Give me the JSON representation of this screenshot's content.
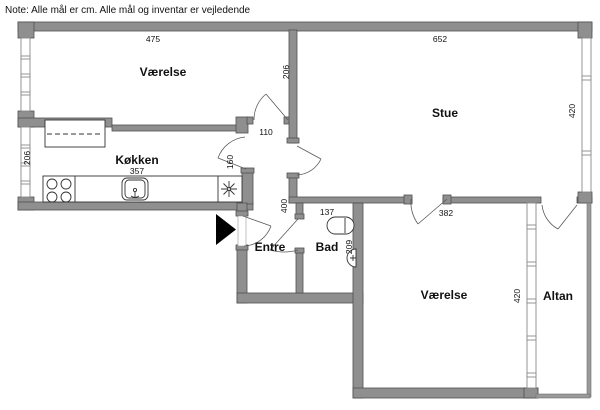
{
  "note": "Note: Alle mål er cm. Alle mål og inventar er vejledende",
  "rooms": {
    "vaerelse_top": {
      "label": "Værelse",
      "width_cm": "475",
      "depth_cm": "206"
    },
    "stue": {
      "label": "Stue",
      "width_cm": "652",
      "depth_cm": "420"
    },
    "koekken": {
      "label": "Køkken",
      "length_cm": "357",
      "depth_cm": "206"
    },
    "hall": {
      "width_cm": "110",
      "opening_cm": "160",
      "length_cm": "400"
    },
    "entre": {
      "label": "Entre"
    },
    "bad": {
      "label": "Bad",
      "width_cm": "137",
      "depth_cm": "209"
    },
    "vaerelse_bottom": {
      "label": "Værelse",
      "width_cm": "382",
      "depth_cm": "420"
    },
    "altan": {
      "label": "Altan"
    }
  },
  "colors": {
    "wall": "#8f8f8f",
    "wall_outline": "#4f4f4f",
    "door": "#5a5a5a",
    "fixture": "#333333",
    "text": "#111111",
    "arrow": "#000000",
    "background": "#ffffff"
  }
}
